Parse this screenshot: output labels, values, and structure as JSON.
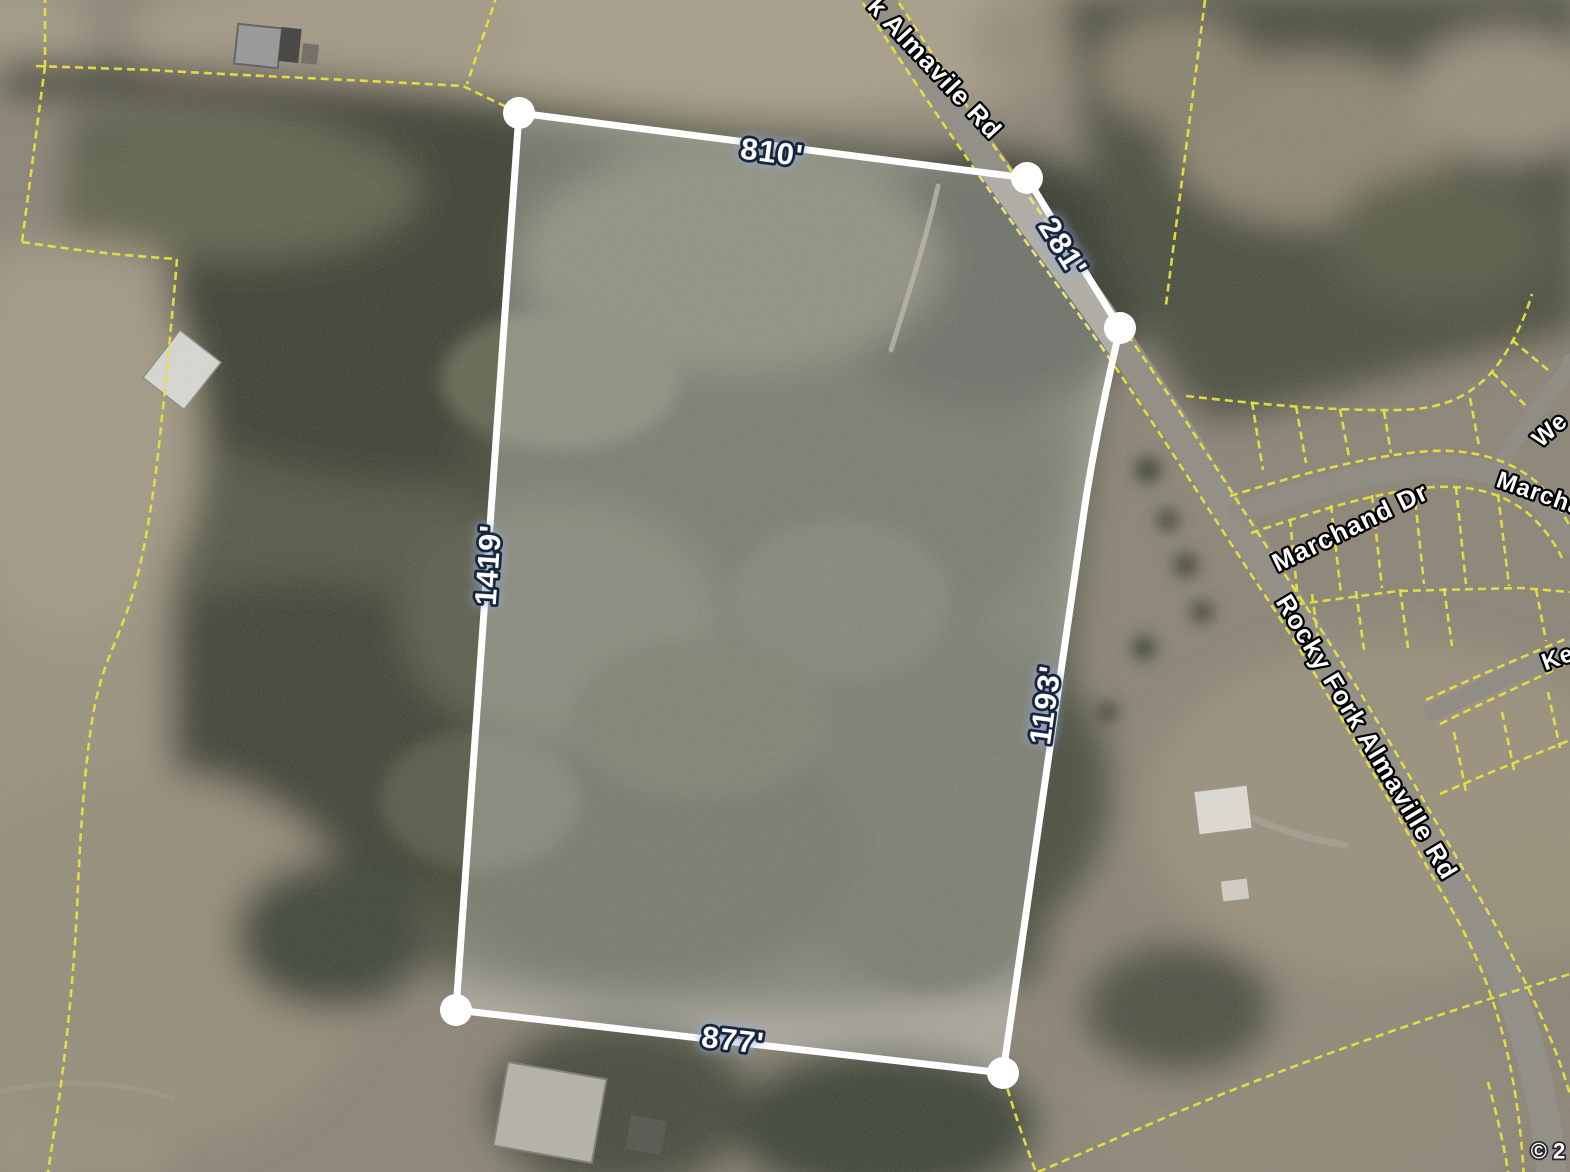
{
  "map_view": {
    "attribution": "© 2",
    "parcel": {
      "dimension_labels": {
        "top": "810'",
        "northeast": "281'",
        "west": "1419'",
        "east": "1193'",
        "south": "877'"
      }
    },
    "road_labels": {
      "top_road": "k Almavile Rd",
      "main_road": "Rocky Fork Almaville Rd",
      "marchand": "Marchand Dr",
      "edge_partial_we": "We",
      "edge_partial_marcha": "Marcha",
      "edge_partial_ke": "Ke"
    },
    "colors": {
      "parcel_outline": "#ffffff",
      "parcel_fill": "rgba(255,255,255,0.27)",
      "boundary_line": "#e6e041",
      "label_halo": "#17233a"
    }
  }
}
